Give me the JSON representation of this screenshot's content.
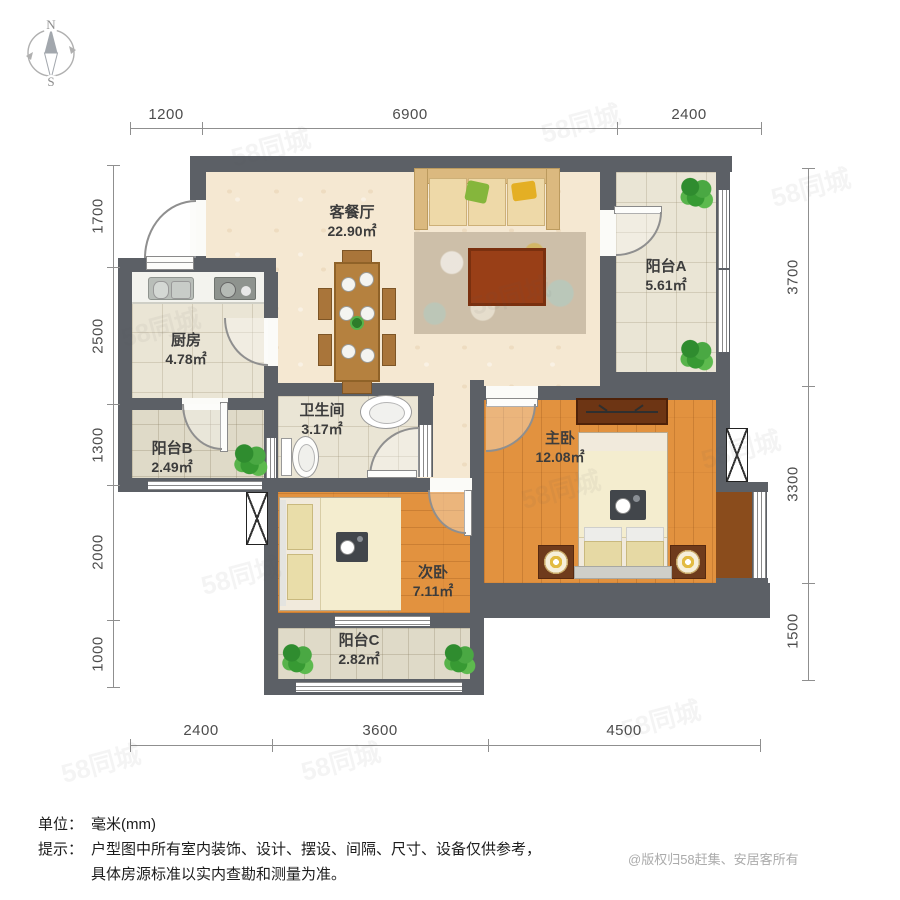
{
  "compass": {
    "north": "N",
    "south": "S"
  },
  "rooms": [
    {
      "name": "客餐厅",
      "area": "22.90㎡"
    },
    {
      "name": "阳台A",
      "area": "5.61㎡"
    },
    {
      "name": "厨房",
      "area": "4.78㎡"
    },
    {
      "name": "阳台B",
      "area": "2.49㎡"
    },
    {
      "name": "卫生间",
      "area": "3.17㎡"
    },
    {
      "name": "主卧",
      "area": "12.08㎡"
    },
    {
      "name": "次卧",
      "area": "7.11㎡"
    },
    {
      "name": "阳台C",
      "area": "2.82㎡"
    }
  ],
  "dimensions": {
    "top": [
      "1200",
      "6900",
      "2400"
    ],
    "bottom": [
      "2400",
      "3600",
      "4500"
    ],
    "left": [
      "1700",
      "2500",
      "1300",
      "2000",
      "1000"
    ],
    "right": [
      "3700",
      "3300",
      "1500"
    ]
  },
  "notes": {
    "unit_label": "单位：",
    "unit_value": "毫米(mm)",
    "tip_label": "提示：",
    "tip_line1": "户型图中所有室内装饰、设计、摆设、间隔、尺寸、设备仅供参考，",
    "tip_line2": "具体房源标准以实内查勘和测量为准。"
  },
  "copyright": "@版权归58赶集、安居客所有",
  "watermark": "58同城",
  "colors": {
    "wall": "#5c6066",
    "living_floor": "#f5e8d2",
    "tile_floor": "#eae5d5",
    "wood_floor": "#e2923f",
    "balcony_tile": "#dfdac8",
    "plant_green": "#3f9d3f",
    "sofa_tan": "#dbb97f",
    "pillow_green": "#85b63c",
    "pillow_yellow": "#e4af24",
    "dim_text": "#4d4d4d"
  }
}
